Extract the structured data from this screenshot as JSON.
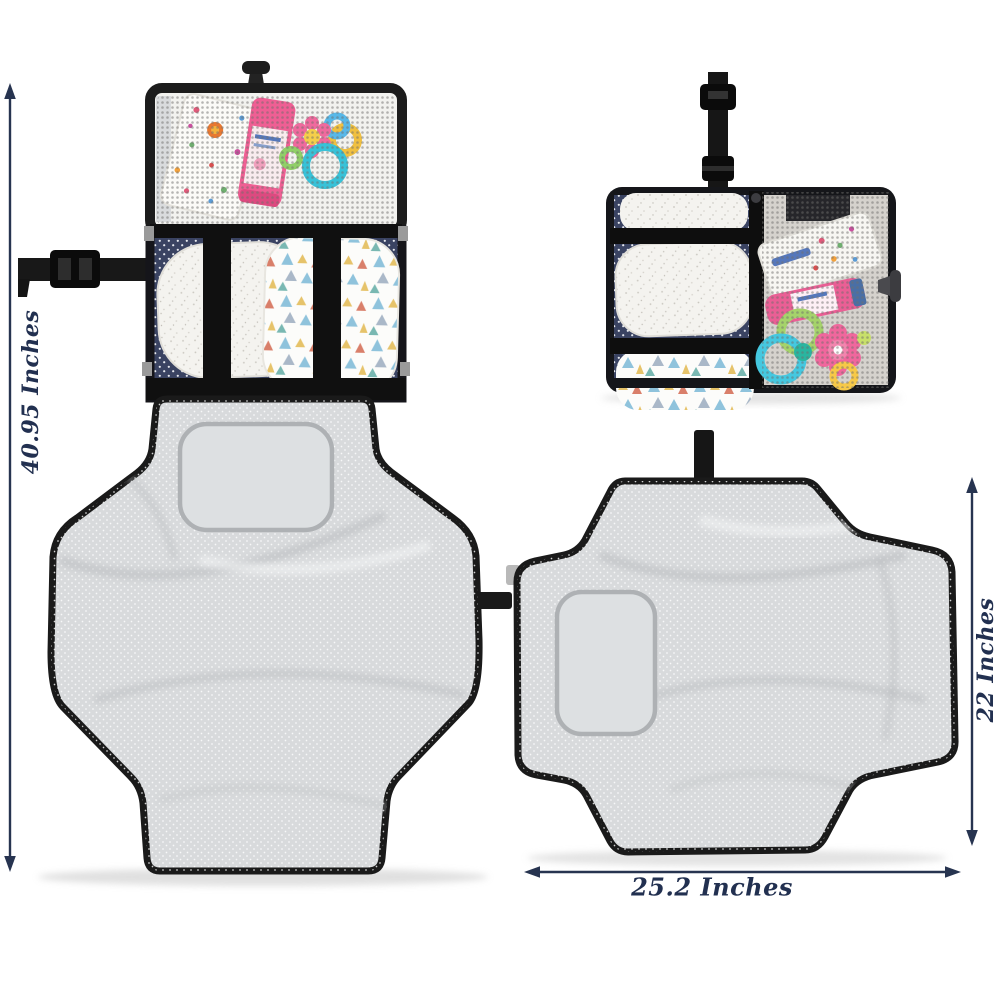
{
  "page": {
    "background_color": "#ffffff"
  },
  "dimensions": {
    "height": {
      "label": "40.95 Inches"
    },
    "open_height": {
      "label": "22 Inches"
    },
    "open_width": {
      "label": "25.2 Inches"
    }
  },
  "colors": {
    "annotation_arrow": "#273450",
    "annotation_text": "#223050",
    "fabric_black": "#161616",
    "navy_polkadot_fabric": "#3a4362",
    "mat_gray": "#d8dadc",
    "mesh_dot": "#6f6e6c",
    "tube_pink": "#ea5f95",
    "teether_pink": "#ef6a9e",
    "teether_blue": "#58b8e8",
    "teether_teal": "#38c2d8",
    "teether_green": "#90cf68",
    "teether_yellow": "#f0c040"
  }
}
